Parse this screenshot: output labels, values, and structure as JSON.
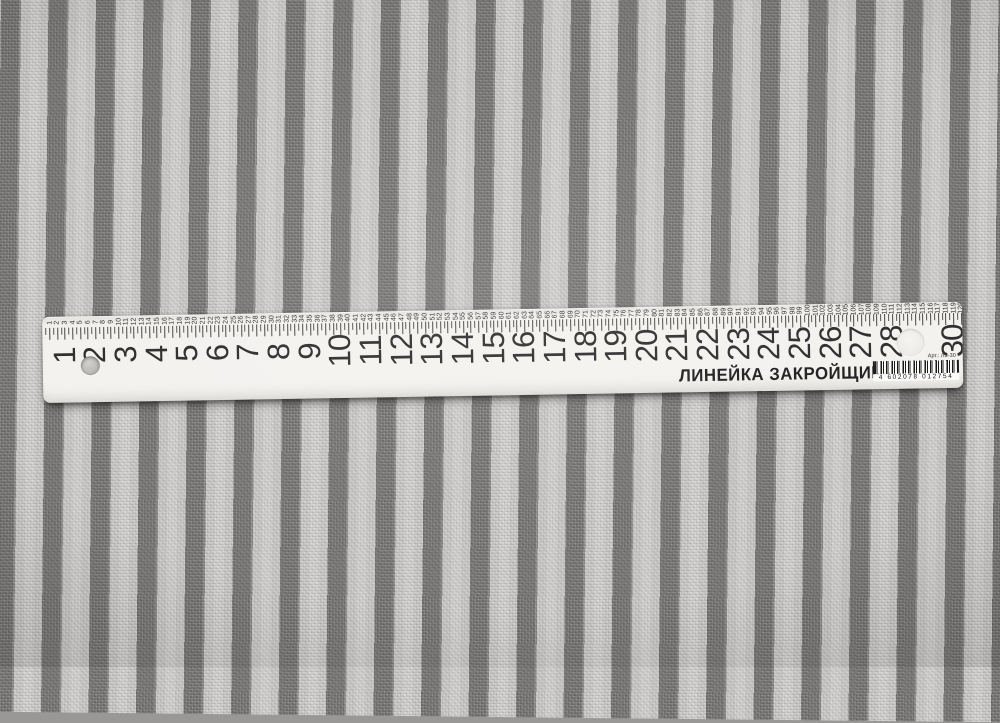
{
  "fabric": {
    "stripe_dark": "#757371",
    "stripe_light": "#cbc9c7"
  },
  "ruler": {
    "brand_text": "ЛИНЕЙКА ЗАКРОЙЩИКА",
    "article_text": "Арт.: ЛЗ-30",
    "barcode_digits": "4 602078 012754",
    "body_color": "#f3f2ef",
    "ink_color": "#2d2d2d",
    "cm_labels": [
      1,
      2,
      3,
      4,
      5,
      6,
      7,
      8,
      9,
      10,
      11,
      12,
      13,
      14,
      15,
      16,
      17,
      18,
      19,
      20,
      21,
      22,
      23,
      24,
      25,
      26,
      27,
      28,
      30
    ],
    "quarter_labels": [
      1,
      2,
      3,
      4,
      5,
      6,
      7,
      8,
      9,
      10,
      11,
      12,
      13,
      14,
      15,
      16,
      17,
      18,
      19,
      20,
      21,
      22,
      23,
      24,
      25,
      26,
      27,
      28,
      29,
      30,
      31,
      32,
      33,
      34,
      35,
      36,
      37,
      38,
      39,
      40,
      41,
      42,
      43,
      44,
      45,
      46,
      47,
      48,
      49,
      50,
      51,
      52,
      53,
      54,
      55,
      56,
      57,
      58,
      59,
      60,
      61,
      62,
      63,
      64,
      65,
      66,
      67,
      68,
      69,
      70,
      71,
      72,
      73,
      74,
      75,
      76,
      77,
      78,
      79,
      80,
      81,
      82,
      83,
      84,
      85,
      86,
      87,
      88,
      89,
      90,
      91,
      92,
      93,
      94,
      95,
      96,
      97,
      98,
      99,
      100,
      101,
      102,
      103,
      104,
      105,
      106,
      107,
      108,
      109,
      110,
      111,
      112,
      113,
      114,
      115,
      116,
      117,
      118,
      119,
      120
    ]
  }
}
